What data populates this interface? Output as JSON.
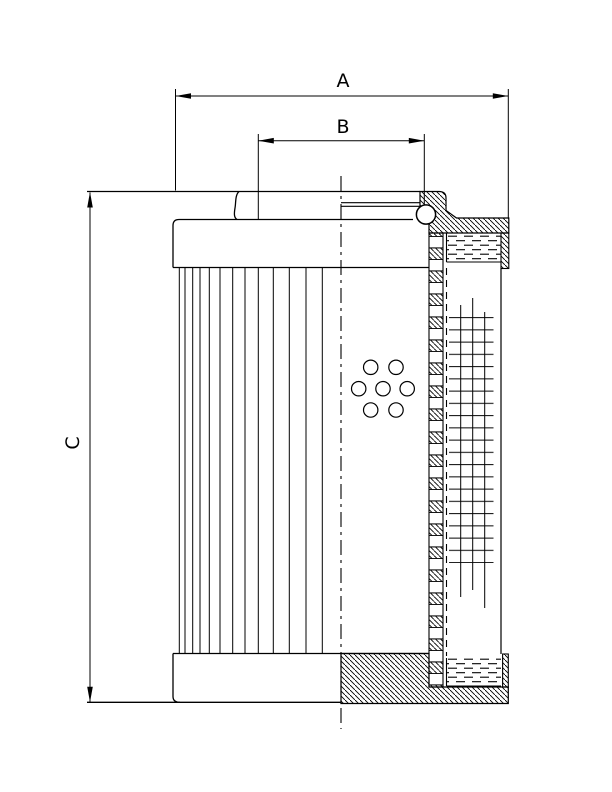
{
  "drawing": {
    "type": "technical-section-drawing",
    "subject": "hydraulic-filter-element",
    "labels": {
      "dim_a": "A",
      "dim_b": "B",
      "dim_c": "C"
    },
    "colors": {
      "ink": "#000000",
      "paper": "#ffffff"
    }
  }
}
